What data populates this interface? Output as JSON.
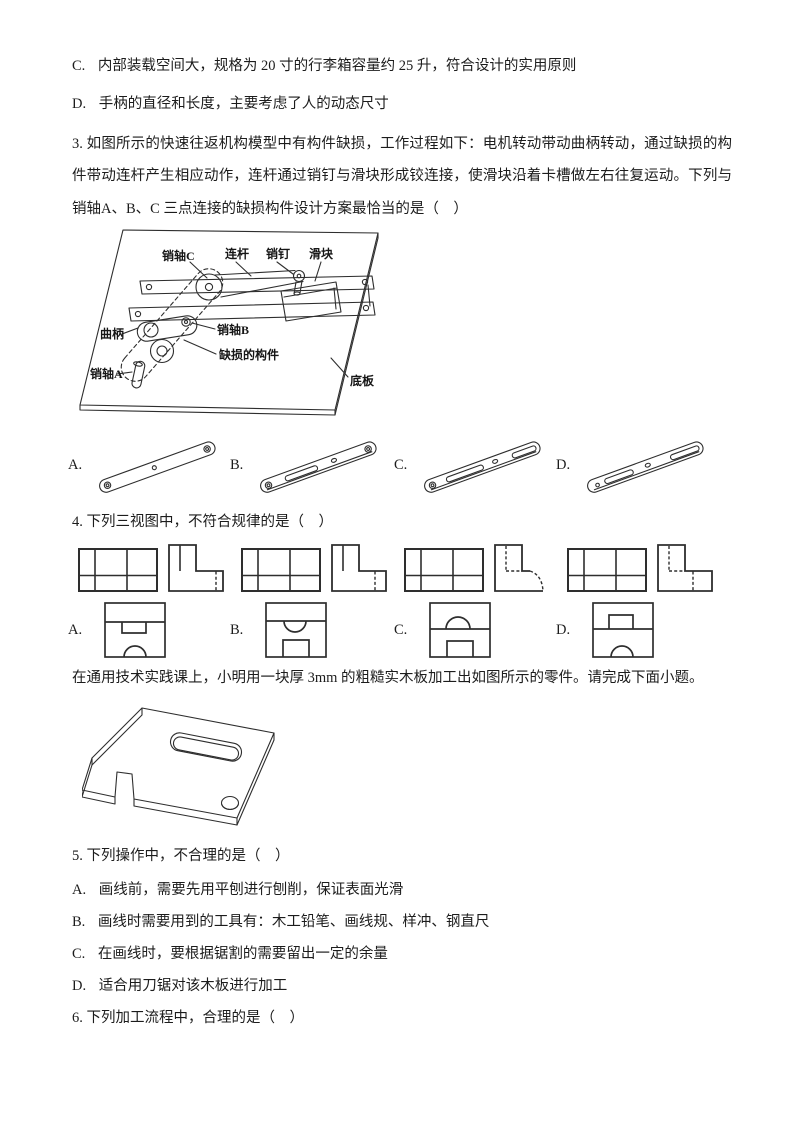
{
  "page": {
    "prev_options": [
      {
        "label": "C.",
        "text": "内部装载空间大，规格为 20 寸的行李箱容量约 25 升，符合设计的实用原则"
      },
      {
        "label": "D.",
        "text": "手柄的直径和长度，主要考虑了人的动态尺寸"
      }
    ],
    "q3": {
      "stem": "3. 如图所示的快速往返机构模型中有构件缺损，工作过程如下：电机转动带动曲柄转动，通过缺损的构件带动连杆产生相应动作，连杆通过销钉与滑块形成铰连接，使滑块沿着卡槽做左右往复运动。下列与销轴A、B、C 三点连接的缺损构件设计方案最恰当的是（　）",
      "figure_labels": {
        "pin_c": "销轴C",
        "link": "连杆",
        "pin": "销钉",
        "slider": "滑块",
        "crank": "曲柄",
        "pin_b": "销轴B",
        "missing": "缺损的构件",
        "pin_a": "销轴A",
        "base": "底板"
      },
      "option_labels": [
        "A.",
        "B.",
        "C.",
        "D."
      ]
    },
    "q4": {
      "stem": "4. 下列三视图中，不符合规律的是（　）",
      "option_labels": [
        "A.",
        "B.",
        "C.",
        "D."
      ]
    },
    "passage": "在通用技术实践课上，小明用一块厚 3mm 的粗糙实木板加工出如图所示的零件。请完成下面小题。",
    "q5": {
      "stem": "5. 下列操作中，不合理的是（　）",
      "options": [
        {
          "label": "A.",
          "text": "画线前，需要先用平刨进行刨削，保证表面光滑"
        },
        {
          "label": "B.",
          "text": "画线时需要用到的工具有：木工铅笔、画线规、样冲、钢直尺"
        },
        {
          "label": "C.",
          "text": "在画线时，要根据锯割的需要留出一定的余量"
        },
        {
          "label": "D.",
          "text": "适合用刀锯对该木板进行加工"
        }
      ]
    },
    "q6": {
      "stem": "6. 下列加工流程中，合理的是（　）"
    }
  }
}
